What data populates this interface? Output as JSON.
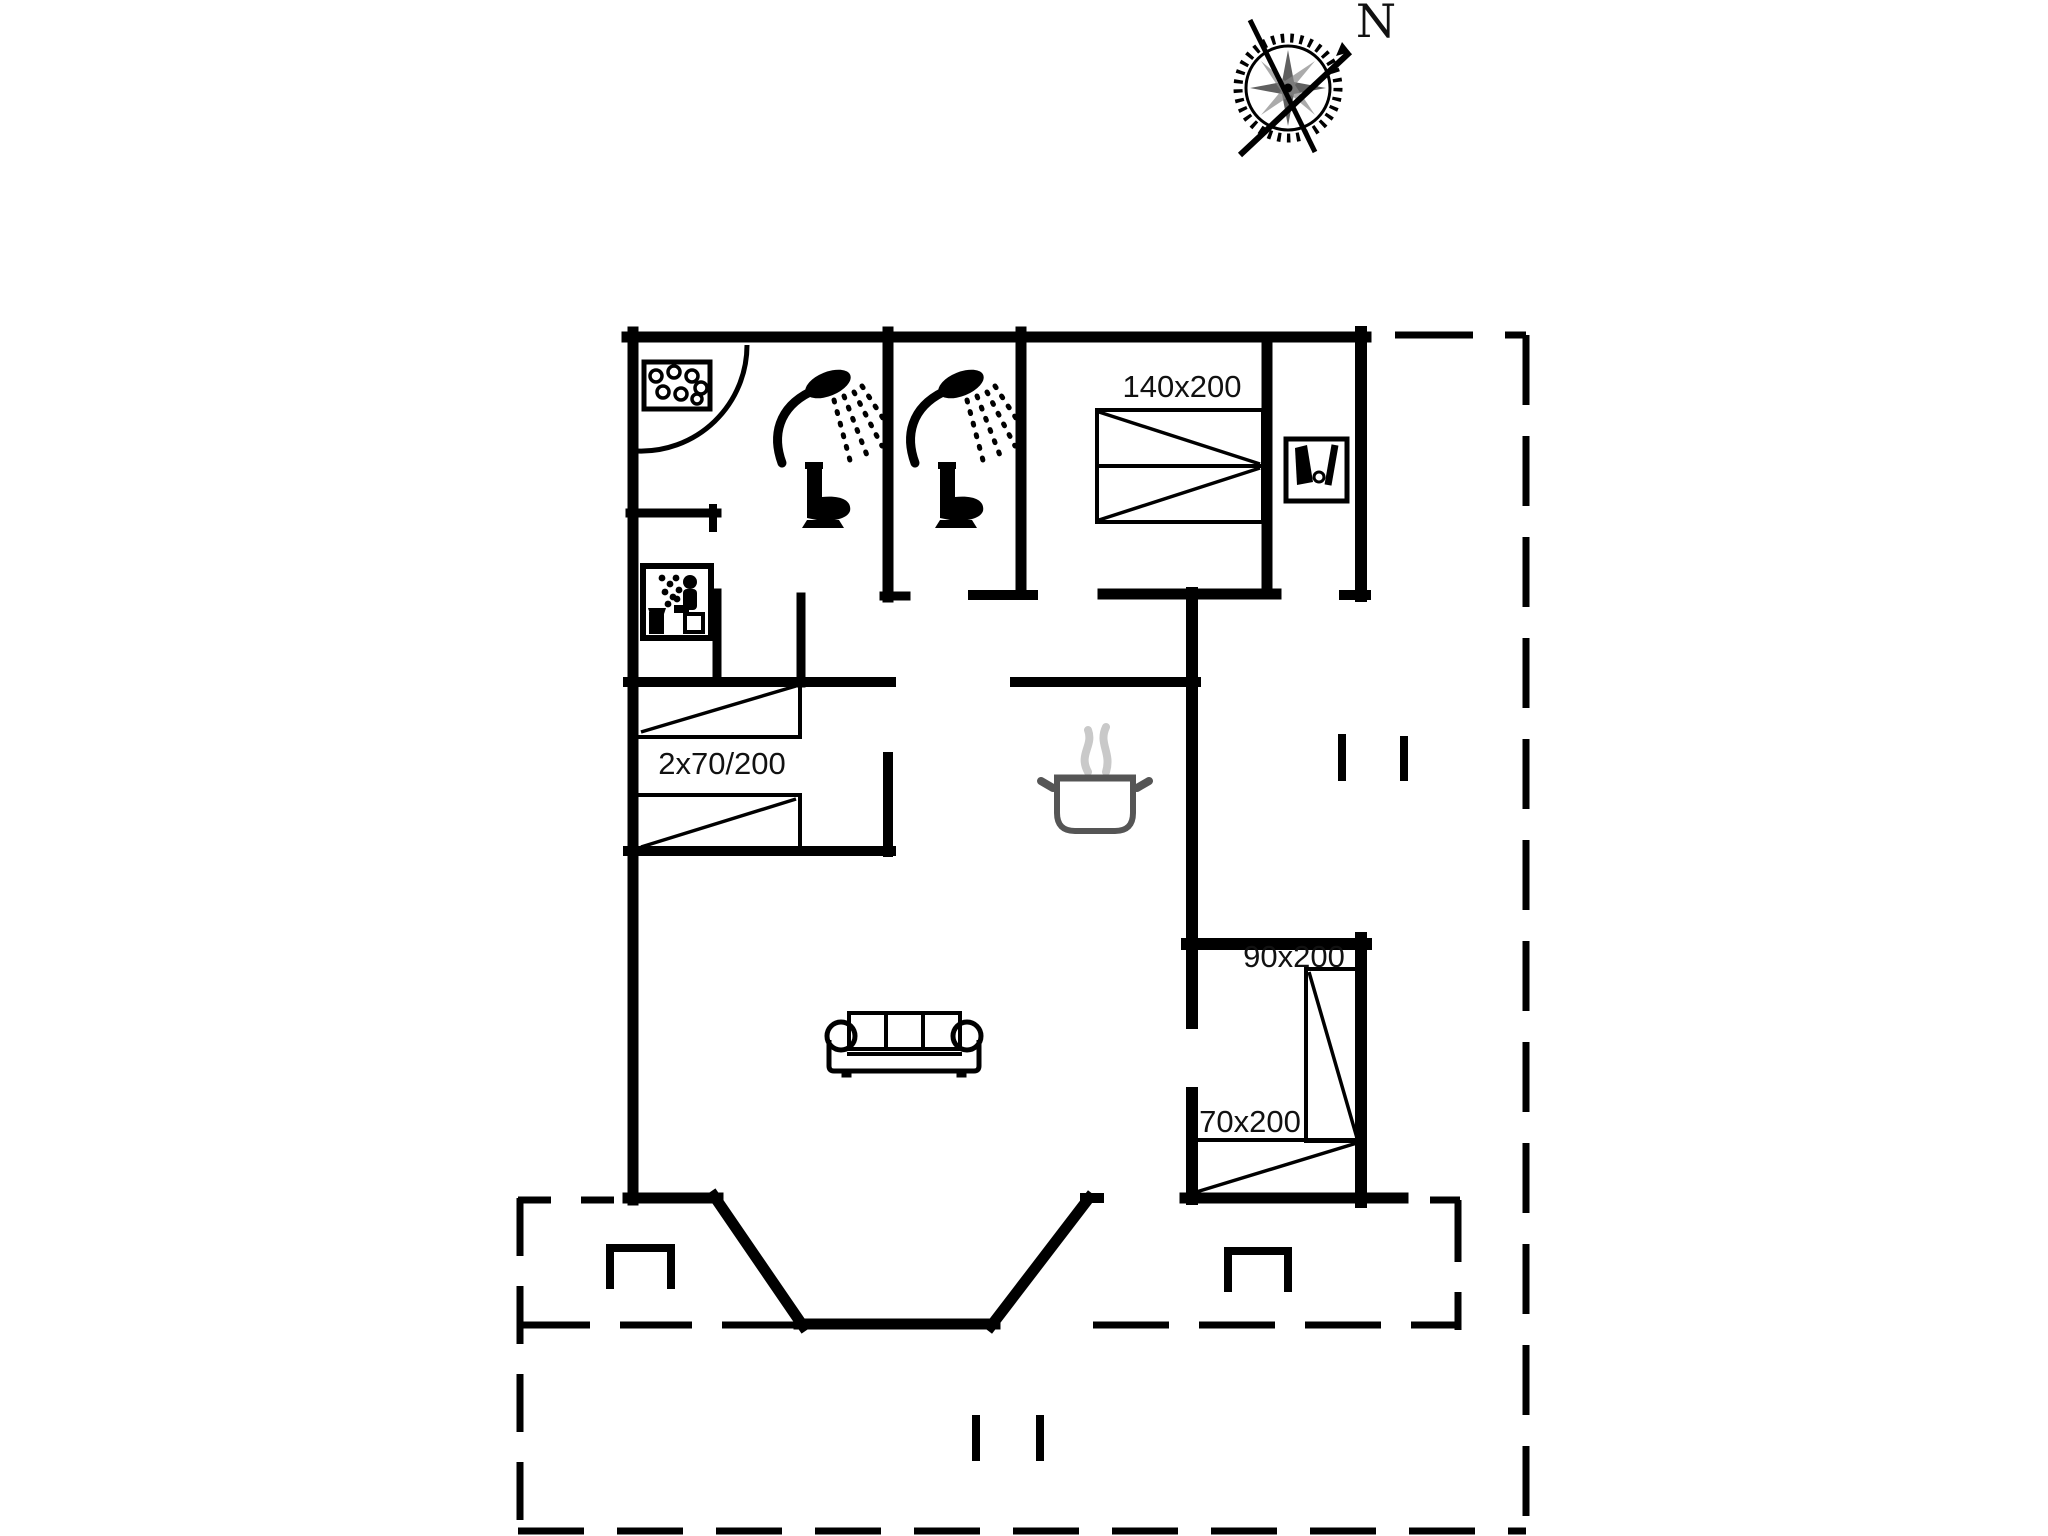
{
  "title": "Holiday home floor plan",
  "compass": {
    "north_label": "N"
  },
  "beds": {
    "double": {
      "label": "140x200"
    },
    "bunk": {
      "label": "2x70/200"
    },
    "single_90": {
      "label": "90x200"
    },
    "single_70": {
      "label": "70x200"
    }
  },
  "icons": {
    "compass_rose": "compass-rose-icon",
    "whirlpool": "whirlpool-icon",
    "shower_1": "shower-icon",
    "shower_2": "shower-icon",
    "toilet_1": "toilet-icon",
    "toilet_2": "toilet-icon",
    "sauna": "sauna-icon",
    "wardrobe": "wardrobe-icon",
    "cooking_pot": "cooking-pot-icon",
    "sofa": "sofa-icon",
    "terrace_post_left": "terrace-post-icon",
    "terrace_post_right": "terrace-post-icon",
    "door_step_marks": "door-step-marks"
  },
  "colors": {
    "line": "#000000",
    "text": "#111111",
    "steam": "#c9c9c9",
    "background": "#ffffff"
  }
}
